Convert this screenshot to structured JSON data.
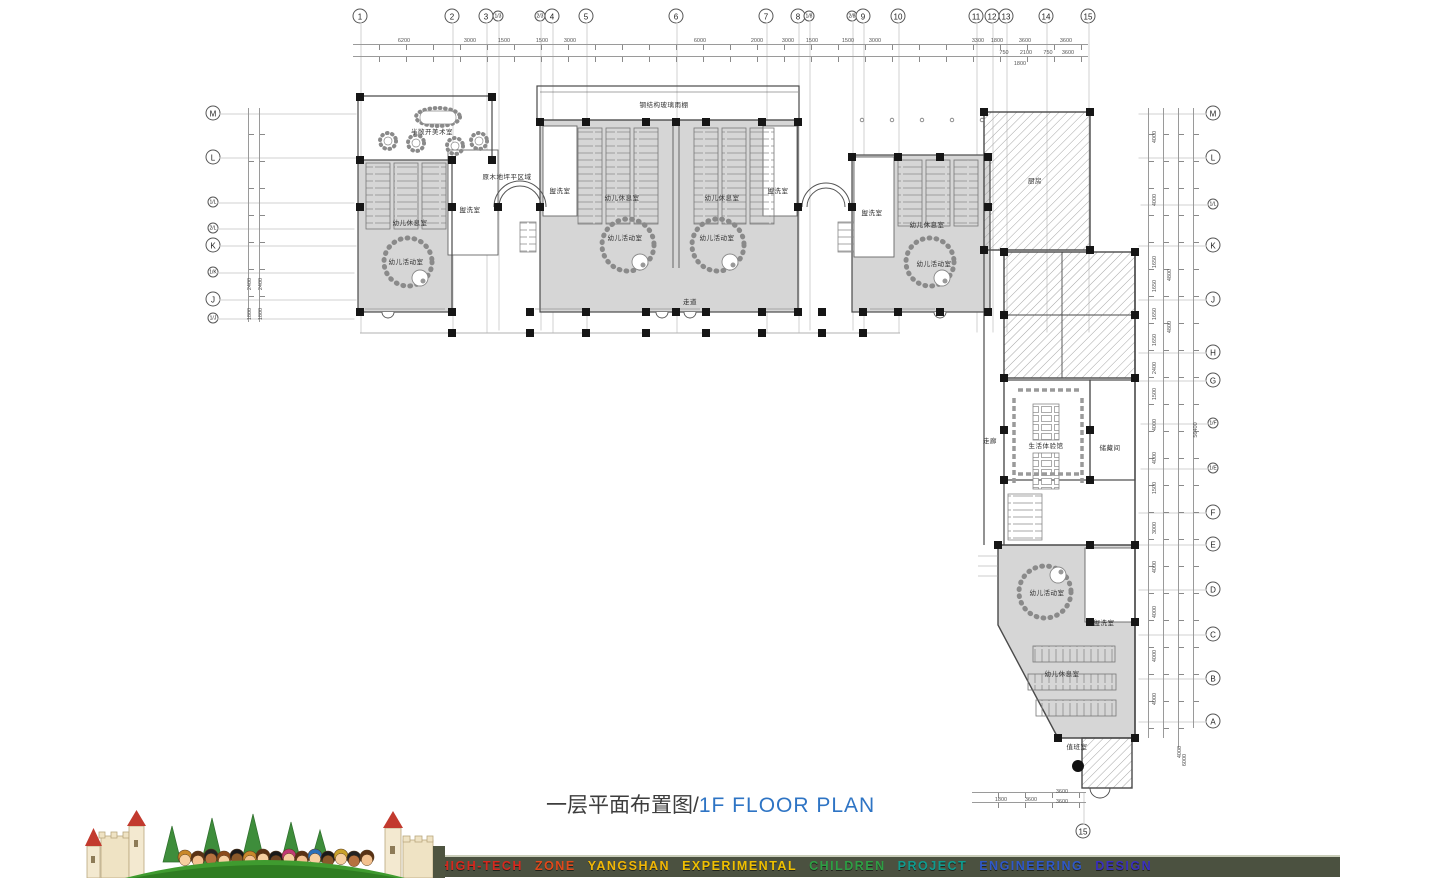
{
  "title": {
    "zh": "一层平面布置图/",
    "en": "1F FLOOR PLAN"
  },
  "footer": {
    "words": [
      {
        "text": "HIGH-TECH",
        "color": "#d6281e"
      },
      {
        "text": "ZONE",
        "color": "#e0481a"
      },
      {
        "text": "YANGSHAN",
        "color": "#f2b705"
      },
      {
        "text": "EXPERIMENTAL",
        "color": "#f0c000"
      },
      {
        "text": "CHILDREN",
        "color": "#2e9e44"
      },
      {
        "text": "PROJECT",
        "color": "#0f9b8e"
      },
      {
        "text": "ENGINEERING",
        "color": "#2f58c8"
      },
      {
        "text": "DESIGN",
        "color": "#3a2fbf"
      }
    ]
  },
  "axes": {
    "top": [
      {
        "label": "1",
        "x": 360,
        "y": 16
      },
      {
        "label": "2",
        "x": 452,
        "y": 16
      },
      {
        "label": "3",
        "x": 486,
        "y": 16
      },
      {
        "label": "1/3",
        "x": 498,
        "y": 16,
        "small": true
      },
      {
        "label": "2/3",
        "x": 540,
        "y": 16,
        "small": true
      },
      {
        "label": "4",
        "x": 552,
        "y": 16
      },
      {
        "label": "5",
        "x": 586,
        "y": 16
      },
      {
        "label": "6",
        "x": 676,
        "y": 16
      },
      {
        "label": "7",
        "x": 766,
        "y": 16
      },
      {
        "label": "8",
        "x": 798,
        "y": 16
      },
      {
        "label": "1/8",
        "x": 809,
        "y": 16,
        "small": true
      },
      {
        "label": "2/8",
        "x": 852,
        "y": 16,
        "small": true
      },
      {
        "label": "9",
        "x": 863,
        "y": 16
      },
      {
        "label": "10",
        "x": 898,
        "y": 16
      },
      {
        "label": "11",
        "x": 976,
        "y": 16
      },
      {
        "label": "12",
        "x": 992,
        "y": 16
      },
      {
        "label": "13",
        "x": 1006,
        "y": 16
      },
      {
        "label": "14",
        "x": 1046,
        "y": 16
      },
      {
        "label": "15",
        "x": 1088,
        "y": 16
      }
    ],
    "left": [
      {
        "label": "M",
        "x": 213,
        "y": 113
      },
      {
        "label": "L",
        "x": 213,
        "y": 157
      },
      {
        "label": "1/L",
        "x": 213,
        "y": 202,
        "small": true
      },
      {
        "label": "2/L",
        "x": 213,
        "y": 228,
        "small": true
      },
      {
        "label": "K",
        "x": 213,
        "y": 245
      },
      {
        "label": "1/K",
        "x": 213,
        "y": 272,
        "small": true
      },
      {
        "label": "J",
        "x": 213,
        "y": 299
      },
      {
        "label": "1/J",
        "x": 213,
        "y": 318,
        "small": true
      }
    ],
    "right": [
      {
        "label": "M",
        "x": 1213,
        "y": 113
      },
      {
        "label": "L",
        "x": 1213,
        "y": 157
      },
      {
        "label": "1/L",
        "x": 1213,
        "y": 204,
        "small": true
      },
      {
        "label": "K",
        "x": 1213,
        "y": 245
      },
      {
        "label": "J",
        "x": 1213,
        "y": 299
      },
      {
        "label": "H",
        "x": 1213,
        "y": 352
      },
      {
        "label": "G",
        "x": 1213,
        "y": 380
      },
      {
        "label": "1/F",
        "x": 1213,
        "y": 423,
        "small": true
      },
      {
        "label": "1/E",
        "x": 1213,
        "y": 468,
        "small": true
      },
      {
        "label": "F",
        "x": 1213,
        "y": 512
      },
      {
        "label": "E",
        "x": 1213,
        "y": 544
      },
      {
        "label": "D",
        "x": 1213,
        "y": 589
      },
      {
        "label": "C",
        "x": 1213,
        "y": 634
      },
      {
        "label": "B",
        "x": 1213,
        "y": 678
      },
      {
        "label": "A",
        "x": 1213,
        "y": 721
      }
    ],
    "bottom": [
      {
        "label": "15",
        "x": 1083,
        "y": 831
      }
    ]
  },
  "dims": {
    "top": [
      {
        "t": "6200",
        "x": 404,
        "y": 41
      },
      {
        "t": "3000",
        "x": 470,
        "y": 41
      },
      {
        "t": "1500",
        "x": 504,
        "y": 41
      },
      {
        "t": "1500",
        "x": 542,
        "y": 41
      },
      {
        "t": "3000",
        "x": 570,
        "y": 41
      },
      {
        "t": "6000",
        "x": 700,
        "y": 41
      },
      {
        "t": "2000",
        "x": 757,
        "y": 41
      },
      {
        "t": "3000",
        "x": 788,
        "y": 41
      },
      {
        "t": "1500",
        "x": 812,
        "y": 41
      },
      {
        "t": "1500",
        "x": 848,
        "y": 41
      },
      {
        "t": "3000",
        "x": 875,
        "y": 41
      },
      {
        "t": "3300",
        "x": 978,
        "y": 41
      },
      {
        "t": "1800",
        "x": 997,
        "y": 41
      },
      {
        "t": "3600",
        "x": 1025,
        "y": 41
      },
      {
        "t": "3600",
        "x": 1066,
        "y": 41
      },
      {
        "t": "750",
        "x": 1004,
        "y": 53
      },
      {
        "t": "2100",
        "x": 1026,
        "y": 53
      },
      {
        "t": "750",
        "x": 1048,
        "y": 53
      },
      {
        "t": "3600",
        "x": 1068,
        "y": 53
      },
      {
        "t": "1800",
        "x": 1020,
        "y": 64
      }
    ],
    "right": [
      {
        "t": "4000",
        "x": 1155,
        "y": 137,
        "rot": true
      },
      {
        "t": "4000",
        "x": 1155,
        "y": 200,
        "rot": true
      },
      {
        "t": "1650",
        "x": 1155,
        "y": 262,
        "rot": true
      },
      {
        "t": "1650",
        "x": 1155,
        "y": 286,
        "rot": true
      },
      {
        "t": "1650",
        "x": 1155,
        "y": 314,
        "rot": true
      },
      {
        "t": "1650",
        "x": 1155,
        "y": 340,
        "rot": true
      },
      {
        "t": "2400",
        "x": 1155,
        "y": 368,
        "rot": true
      },
      {
        "t": "1500",
        "x": 1155,
        "y": 394,
        "rot": true
      },
      {
        "t": "4000",
        "x": 1155,
        "y": 425,
        "rot": true
      },
      {
        "t": "4000",
        "x": 1155,
        "y": 458,
        "rot": true
      },
      {
        "t": "1500",
        "x": 1155,
        "y": 488,
        "rot": true
      },
      {
        "t": "3000",
        "x": 1155,
        "y": 528,
        "rot": true
      },
      {
        "t": "4000",
        "x": 1155,
        "y": 567,
        "rot": true
      },
      {
        "t": "4000",
        "x": 1155,
        "y": 612,
        "rot": true
      },
      {
        "t": "4000",
        "x": 1155,
        "y": 656,
        "rot": true
      },
      {
        "t": "4000",
        "x": 1155,
        "y": 699,
        "rot": true
      },
      {
        "t": "4800",
        "x": 1170,
        "y": 275,
        "rot": true
      },
      {
        "t": "4800",
        "x": 1170,
        "y": 327,
        "rot": true
      },
      {
        "t": "4000",
        "x": 1180,
        "y": 752,
        "rot": true
      },
      {
        "t": "56400",
        "x": 1196,
        "y": 430,
        "rot": true
      },
      {
        "t": "6000",
        "x": 1185,
        "y": 760,
        "rot": true
      }
    ],
    "left": [
      {
        "t": "2400",
        "x": 250,
        "y": 284,
        "rot": true
      },
      {
        "t": "1800",
        "x": 250,
        "y": 314,
        "rot": true
      },
      {
        "t": "2400",
        "x": 261,
        "y": 284,
        "rot": true
      },
      {
        "t": "1800",
        "x": 261,
        "y": 314,
        "rot": true
      }
    ],
    "bottom": [
      {
        "t": "1800",
        "x": 1001,
        "y": 800
      },
      {
        "t": "3600",
        "x": 1031,
        "y": 800
      },
      {
        "t": "3600",
        "x": 1062,
        "y": 792
      },
      {
        "t": "3600",
        "x": 1062,
        "y": 802
      }
    ]
  },
  "rooms": [
    {
      "label": "半敞开美术室",
      "x": 432,
      "y": 131
    },
    {
      "label": "钢结构玻璃雨棚",
      "x": 664,
      "y": 104
    },
    {
      "label": "原木地坪平区域",
      "x": 507,
      "y": 176
    },
    {
      "label": "幼儿休息室",
      "x": 410,
      "y": 222
    },
    {
      "label": "幼儿活动室",
      "x": 406,
      "y": 261
    },
    {
      "label": "盥洗室",
      "x": 470,
      "y": 209
    },
    {
      "label": "盥洗室",
      "x": 560,
      "y": 190
    },
    {
      "label": "幼儿休息室",
      "x": 622,
      "y": 197
    },
    {
      "label": "幼儿休息室",
      "x": 722,
      "y": 197
    },
    {
      "label": "幼儿活动室",
      "x": 625,
      "y": 237
    },
    {
      "label": "幼儿活动室",
      "x": 717,
      "y": 237
    },
    {
      "label": "盥洗室",
      "x": 778,
      "y": 190
    },
    {
      "label": "盥洗室",
      "x": 872,
      "y": 212
    },
    {
      "label": "幼儿休息室",
      "x": 927,
      "y": 224
    },
    {
      "label": "幼儿活动室",
      "x": 934,
      "y": 263
    },
    {
      "label": "厨房",
      "x": 1035,
      "y": 180
    },
    {
      "label": "走道",
      "x": 690,
      "y": 301
    },
    {
      "label": "走廊",
      "x": 990,
      "y": 440
    },
    {
      "label": "生活体验馆",
      "x": 1046,
      "y": 445
    },
    {
      "label": "储藏间",
      "x": 1110,
      "y": 447
    },
    {
      "label": "幼儿活动室",
      "x": 1047,
      "y": 592
    },
    {
      "label": "盥洗室",
      "x": 1104,
      "y": 622
    },
    {
      "label": "幼儿休息室",
      "x": 1062,
      "y": 673
    },
    {
      "label": "值班室",
      "x": 1077,
      "y": 746
    }
  ]
}
